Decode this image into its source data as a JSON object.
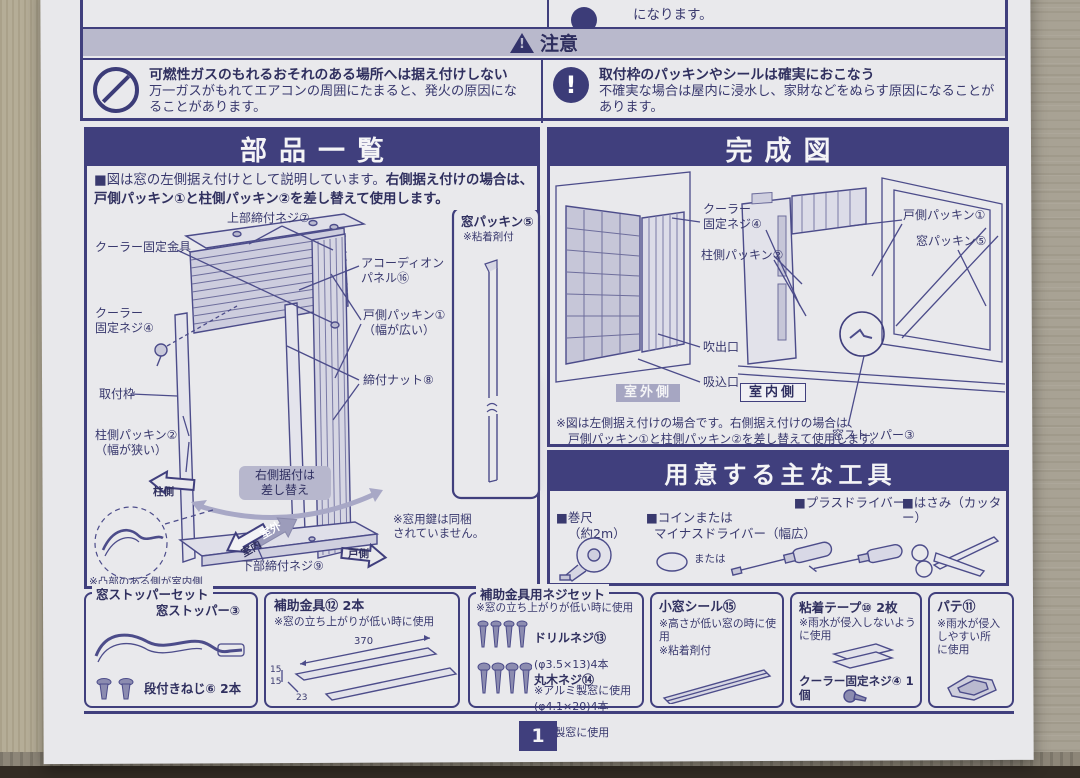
{
  "caution": {
    "band_label": "注意",
    "band_icon_glyph": "!",
    "prev_fragment": "になります。",
    "left": {
      "title": "可燃性ガスのもれるおそれのある場所へは据え付けしない",
      "body": "万一ガスがもれてエアコンの周囲にたまると、発火の原因になることがあります。"
    },
    "right": {
      "icon_glyph": "!",
      "title": "取付枠のパッキンやシールは確実におこなう",
      "body": "不確実な場合は屋内に浸水し、家財などをぬらす原因になることがあります。"
    }
  },
  "parts": {
    "title": "部品一覧",
    "intro1": "■図は窓の左側据え付けとして説明しています。",
    "intro2": "右側据え付けの場合は、戸側パッキン①と柱側パッキン②を差し替えて使用します。",
    "labels": {
      "upper_screw": "上部締付ネジ⑦",
      "bracket": "クーラー固定金具",
      "fix_screw": "クーラー\n固定ネジ④",
      "frame": "取付枠",
      "accordion": "アコーディオン\nパネル⑯",
      "door_packing": "戸側パッキン①\n（幅が広い）",
      "nut": "締付ナット⑧",
      "pillar_packing": "柱側パッキン②\n（幅が狭い）",
      "swap": "右側据付は\n差し替え",
      "pillar_side": "柱側",
      "door_side": "戸側",
      "outdoor": "室外",
      "indoor": "室内",
      "lower_screw": "下部締付ネジ⑨",
      "indoor_note": "※凸部のある側が室内側"
    },
    "packing_box": {
      "title": "窓パッキン⑤",
      "note": "※粘着剤付"
    },
    "key_note": "※窓用鍵は同梱\nされていません。"
  },
  "finished": {
    "title": "完成図",
    "labels": {
      "fix_screw": "クーラー\n固定ネジ④",
      "pillar_packing": "柱側パッキン②",
      "door_packing": "戸側パッキン①",
      "window_packing": "窓パッキン⑤",
      "outlet": "吹出口",
      "inlet": "吸込口",
      "stopper": "窓ストッパー③",
      "outdoor_side": "室外側",
      "indoor_side": "室内側"
    },
    "footnote1": "※図は左側据え付けの場合です。右側据え付けの場合は、",
    "footnote2": "戸側パッキン①と柱側パッキン②を差し替えて使用します。"
  },
  "tools": {
    "title": "用意する主な工具",
    "tape": {
      "label": "■巻尺",
      "sub": "（約2m）"
    },
    "coin": {
      "label": "■コインまたは",
      "sub": "マイナスドライバー（幅広）",
      "or": "または"
    },
    "phillips": {
      "label": "■プラスドライバー"
    },
    "scissors": {
      "label": "■はさみ（カッター）"
    }
  },
  "boxes": {
    "stopper_set": {
      "legend": "窓ストッパーセット",
      "item": "窓ストッパー③",
      "screws": "段付きねじ⑥ 2本"
    },
    "aux_bracket": {
      "title": "補助金具⑫ 2本",
      "note": "※窓の立ち上がりが低い時に使用",
      "dim_len": "370",
      "dim_h1": "15",
      "dim_h2": "15",
      "dim_w": "23"
    },
    "screw_set": {
      "legend": "補助金具用ネジセット",
      "note": "※窓の立ち上がりが低い時に使用",
      "drill": {
        "name": "ドリルネジ⑬",
        "spec": "(φ3.5×13)4本",
        "note": "※アルミ製窓に使用"
      },
      "wood": {
        "name": "丸木ネジ⑭",
        "spec": "(φ4.1×20)4本",
        "note": "※木製窓に使用"
      }
    },
    "small_seal": {
      "title": "小窓シール⑮",
      "note1": "※高さが低い窓の時に使用",
      "note2": "※粘着剤付"
    },
    "tape2": {
      "title": "粘着テープ⑩ 2枚",
      "note": "※雨水が侵入しないよう\nに使用",
      "extra": "クーラー固定ネジ④ 1個"
    },
    "putty": {
      "title": "パテ⑪",
      "note": "※雨水が侵入\nしやすい所\nに使用"
    }
  },
  "page_number": "1",
  "colors": {
    "navy": "#403f7d",
    "band": "#b9b9cc",
    "paper": "#e8e8eb",
    "halftone": "#9c9cbb"
  }
}
